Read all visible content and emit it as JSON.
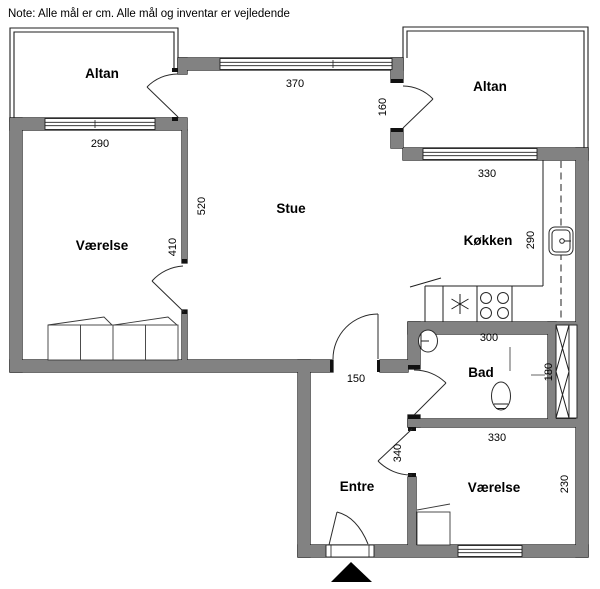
{
  "note": "Note: Alle mål er cm. Alle mål og inventar er vejledende",
  "colors": {
    "background": "#ffffff",
    "wall_fill": "#828282",
    "wall_outline": "#1f1f1f",
    "text": "#000000"
  },
  "rooms": {
    "altan_left": {
      "label": "Altan"
    },
    "altan_right": {
      "label": "Altan"
    },
    "stue": {
      "label": "Stue"
    },
    "vaerelse_left": {
      "label": "Værelse"
    },
    "koekken": {
      "label": "Køkken"
    },
    "bad": {
      "label": "Bad"
    },
    "entre": {
      "label": "Entre"
    },
    "vaerelse_bottom": {
      "label": "Værelse"
    }
  },
  "dimensions_cm": {
    "stue_window": "370",
    "altan_right_door": "160",
    "vaerelse_left_window": "290",
    "koekken_window": "330",
    "stue_west_wall": "520",
    "vaerelse_left_depth": "410",
    "koekken_depth": "290",
    "bad_width": "300",
    "bad_depth": "180",
    "entre_stue_opening": "150",
    "entre_depth": "340",
    "vaerelse_bottom_width": "330",
    "vaerelse_bottom_depth": "230"
  },
  "icons": {
    "stove": "stove-burners-icon",
    "kitchen_sink": "kitchen-sink-icon",
    "hob_symbol": "asterisk-icon",
    "washbasin": "washbasin-icon",
    "toilet": "toilet-icon",
    "wardrobe_left": "wardrobe-icon",
    "wardrobe_bottom": "wardrobe-icon",
    "shaft": "installation-shaft-icon",
    "entrance_marker": "entrance-arrow-icon"
  }
}
